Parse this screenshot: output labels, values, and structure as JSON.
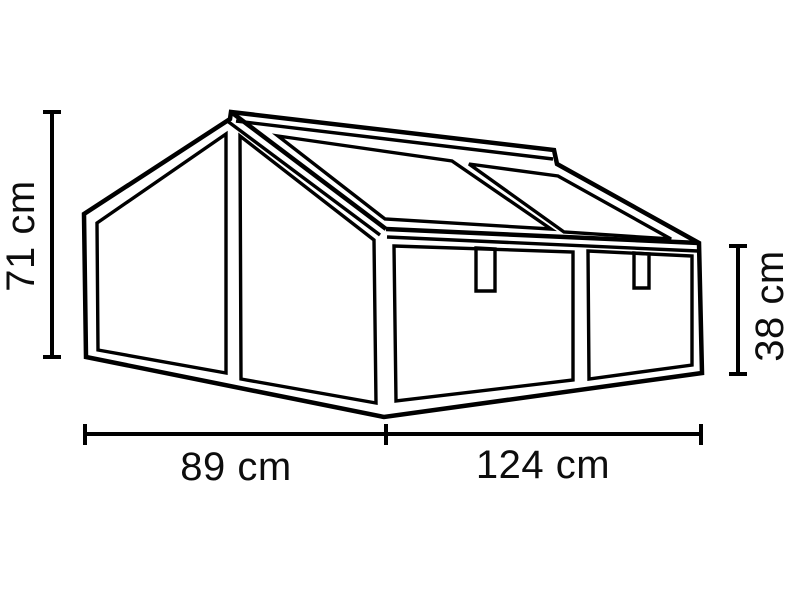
{
  "diagram": {
    "description": "Technical line drawing of a gabled cold frame greenhouse with dimension lines",
    "colors": {
      "stroke": "#000000",
      "background": "#ffffff",
      "label_text": "#0d0d0d"
    },
    "labels": {
      "overall_height": "71 cm",
      "front_height": "38 cm",
      "depth": "89 cm",
      "width": "124 cm"
    }
  }
}
